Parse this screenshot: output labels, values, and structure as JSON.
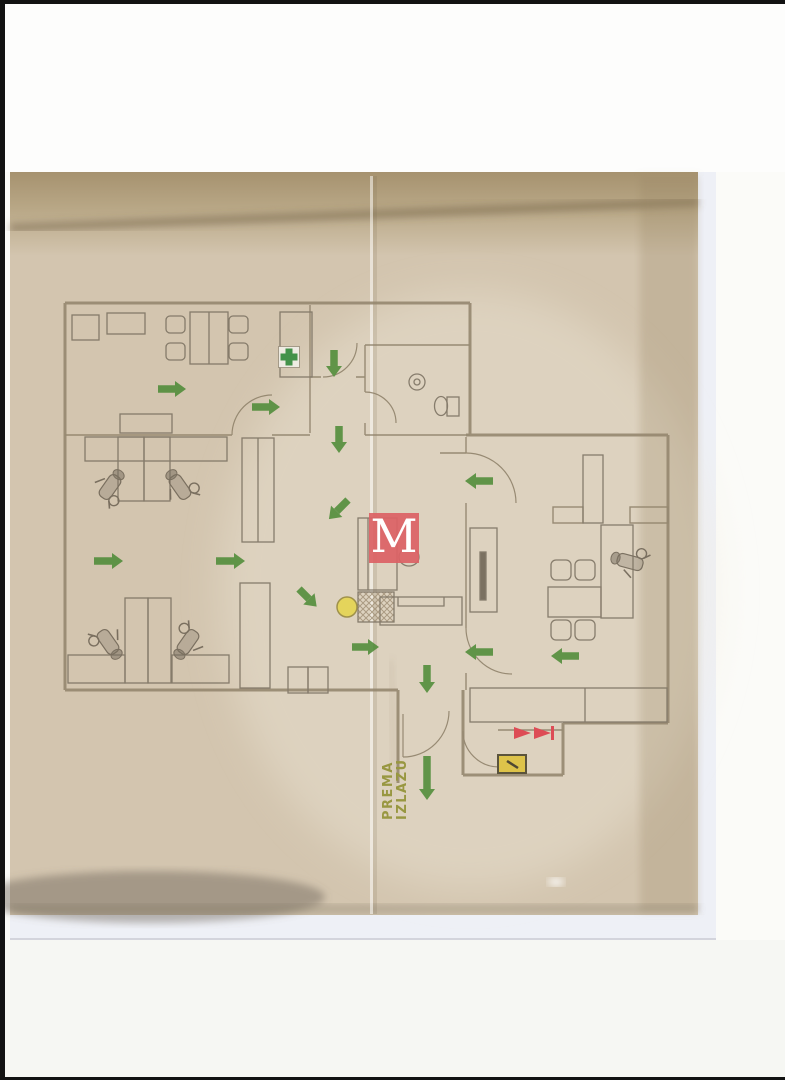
{
  "page": {
    "description": "Scanned evacuation floor plan of a dental clinic / office",
    "exit_label": {
      "line1": "PREMA",
      "line2": "IZLAZU"
    },
    "watermark": {
      "letter": "M"
    }
  },
  "colors": {
    "arrow_green": "#4f8c38",
    "cross_green": "#2f8b3c",
    "watermark_red": "#db6265",
    "marker_yellow": "#e5d54e",
    "hydrant_red": "#dd3a47",
    "panel_yellow": "#ddc23b",
    "exit_text_olive": "#8f9030",
    "wall_line": "#8e8169",
    "paper_beige": "#d3c5af"
  },
  "floor_plan": {
    "arrows": [
      {
        "x": 158,
        "y": 389,
        "dir": "right",
        "len": 28
      },
      {
        "x": 252,
        "y": 407,
        "dir": "right",
        "len": 28
      },
      {
        "x": 334,
        "y": 350,
        "dir": "down",
        "len": 27
      },
      {
        "x": 339,
        "y": 426,
        "dir": "down",
        "len": 27
      },
      {
        "x": 94,
        "y": 561,
        "dir": "right",
        "len": 29
      },
      {
        "x": 216,
        "y": 561,
        "dir": "right",
        "len": 29
      },
      {
        "x": 348,
        "y": 500,
        "dir": "down-left",
        "len": 27
      },
      {
        "x": 493,
        "y": 481,
        "dir": "left",
        "len": 28
      },
      {
        "x": 299,
        "y": 589,
        "dir": "down-right",
        "len": 25
      },
      {
        "x": 352,
        "y": 647,
        "dir": "right",
        "len": 27
      },
      {
        "x": 493,
        "y": 652,
        "dir": "left",
        "len": 28
      },
      {
        "x": 427,
        "y": 665,
        "dir": "down",
        "len": 28
      },
      {
        "x": 579,
        "y": 656,
        "dir": "left",
        "len": 28
      },
      {
        "x": 427,
        "y": 756,
        "dir": "down",
        "len": 44
      }
    ],
    "symbols": {
      "first_aid_cross": {
        "x": 289,
        "y": 357
      },
      "assembly_marker": {
        "x": 347,
        "y": 607
      },
      "fire_hydrant": {
        "x": 533,
        "y": 733
      },
      "electrical_panel": {
        "x": 512,
        "y": 764
      }
    }
  }
}
